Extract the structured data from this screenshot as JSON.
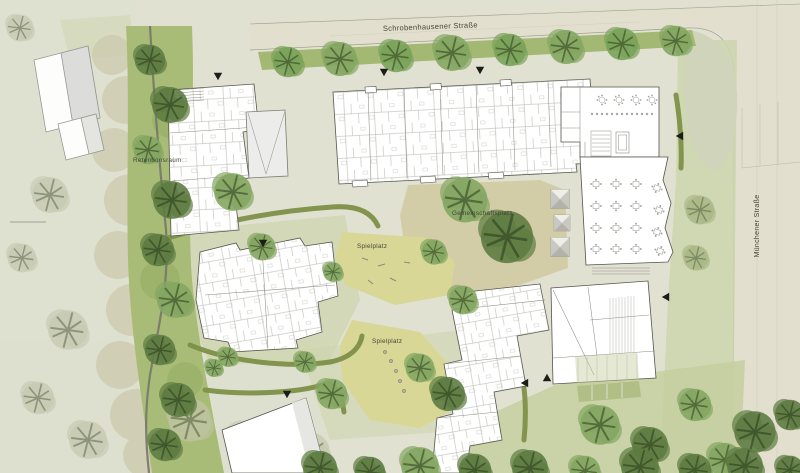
{
  "plan": {
    "type": "architectural-site-plan",
    "labels": {
      "street_top": "Schrobenhausener Straße",
      "street_right": "Münchener Straße",
      "retention_area": "Retentionsraum",
      "community_plaza": "Gemeinschaftsplatz",
      "playground_upper": "Spielplatz",
      "playground_lower": "Spielplatz"
    },
    "icons": {
      "entrance_marker": "filled-black-triangle",
      "skylight": "pyramid-square",
      "table": "square-table-with-chairs"
    },
    "palette": {
      "paper": "#e1e1d2",
      "street": "#e2dfce",
      "verge_green": "#a3b873",
      "lawn": "#c8d1a2",
      "hedge": "#7e9048",
      "plaza_tan": "#d2cba2",
      "play_yellow": "#d8d795",
      "tree_green": "#7ba35a",
      "tree_dark": "#5e7c42",
      "tree_faded": "#c3c5ab",
      "building": "#ffffff",
      "building_line": "#53534b",
      "stream": "#75776c",
      "marker": "#1c1c1a"
    }
  }
}
